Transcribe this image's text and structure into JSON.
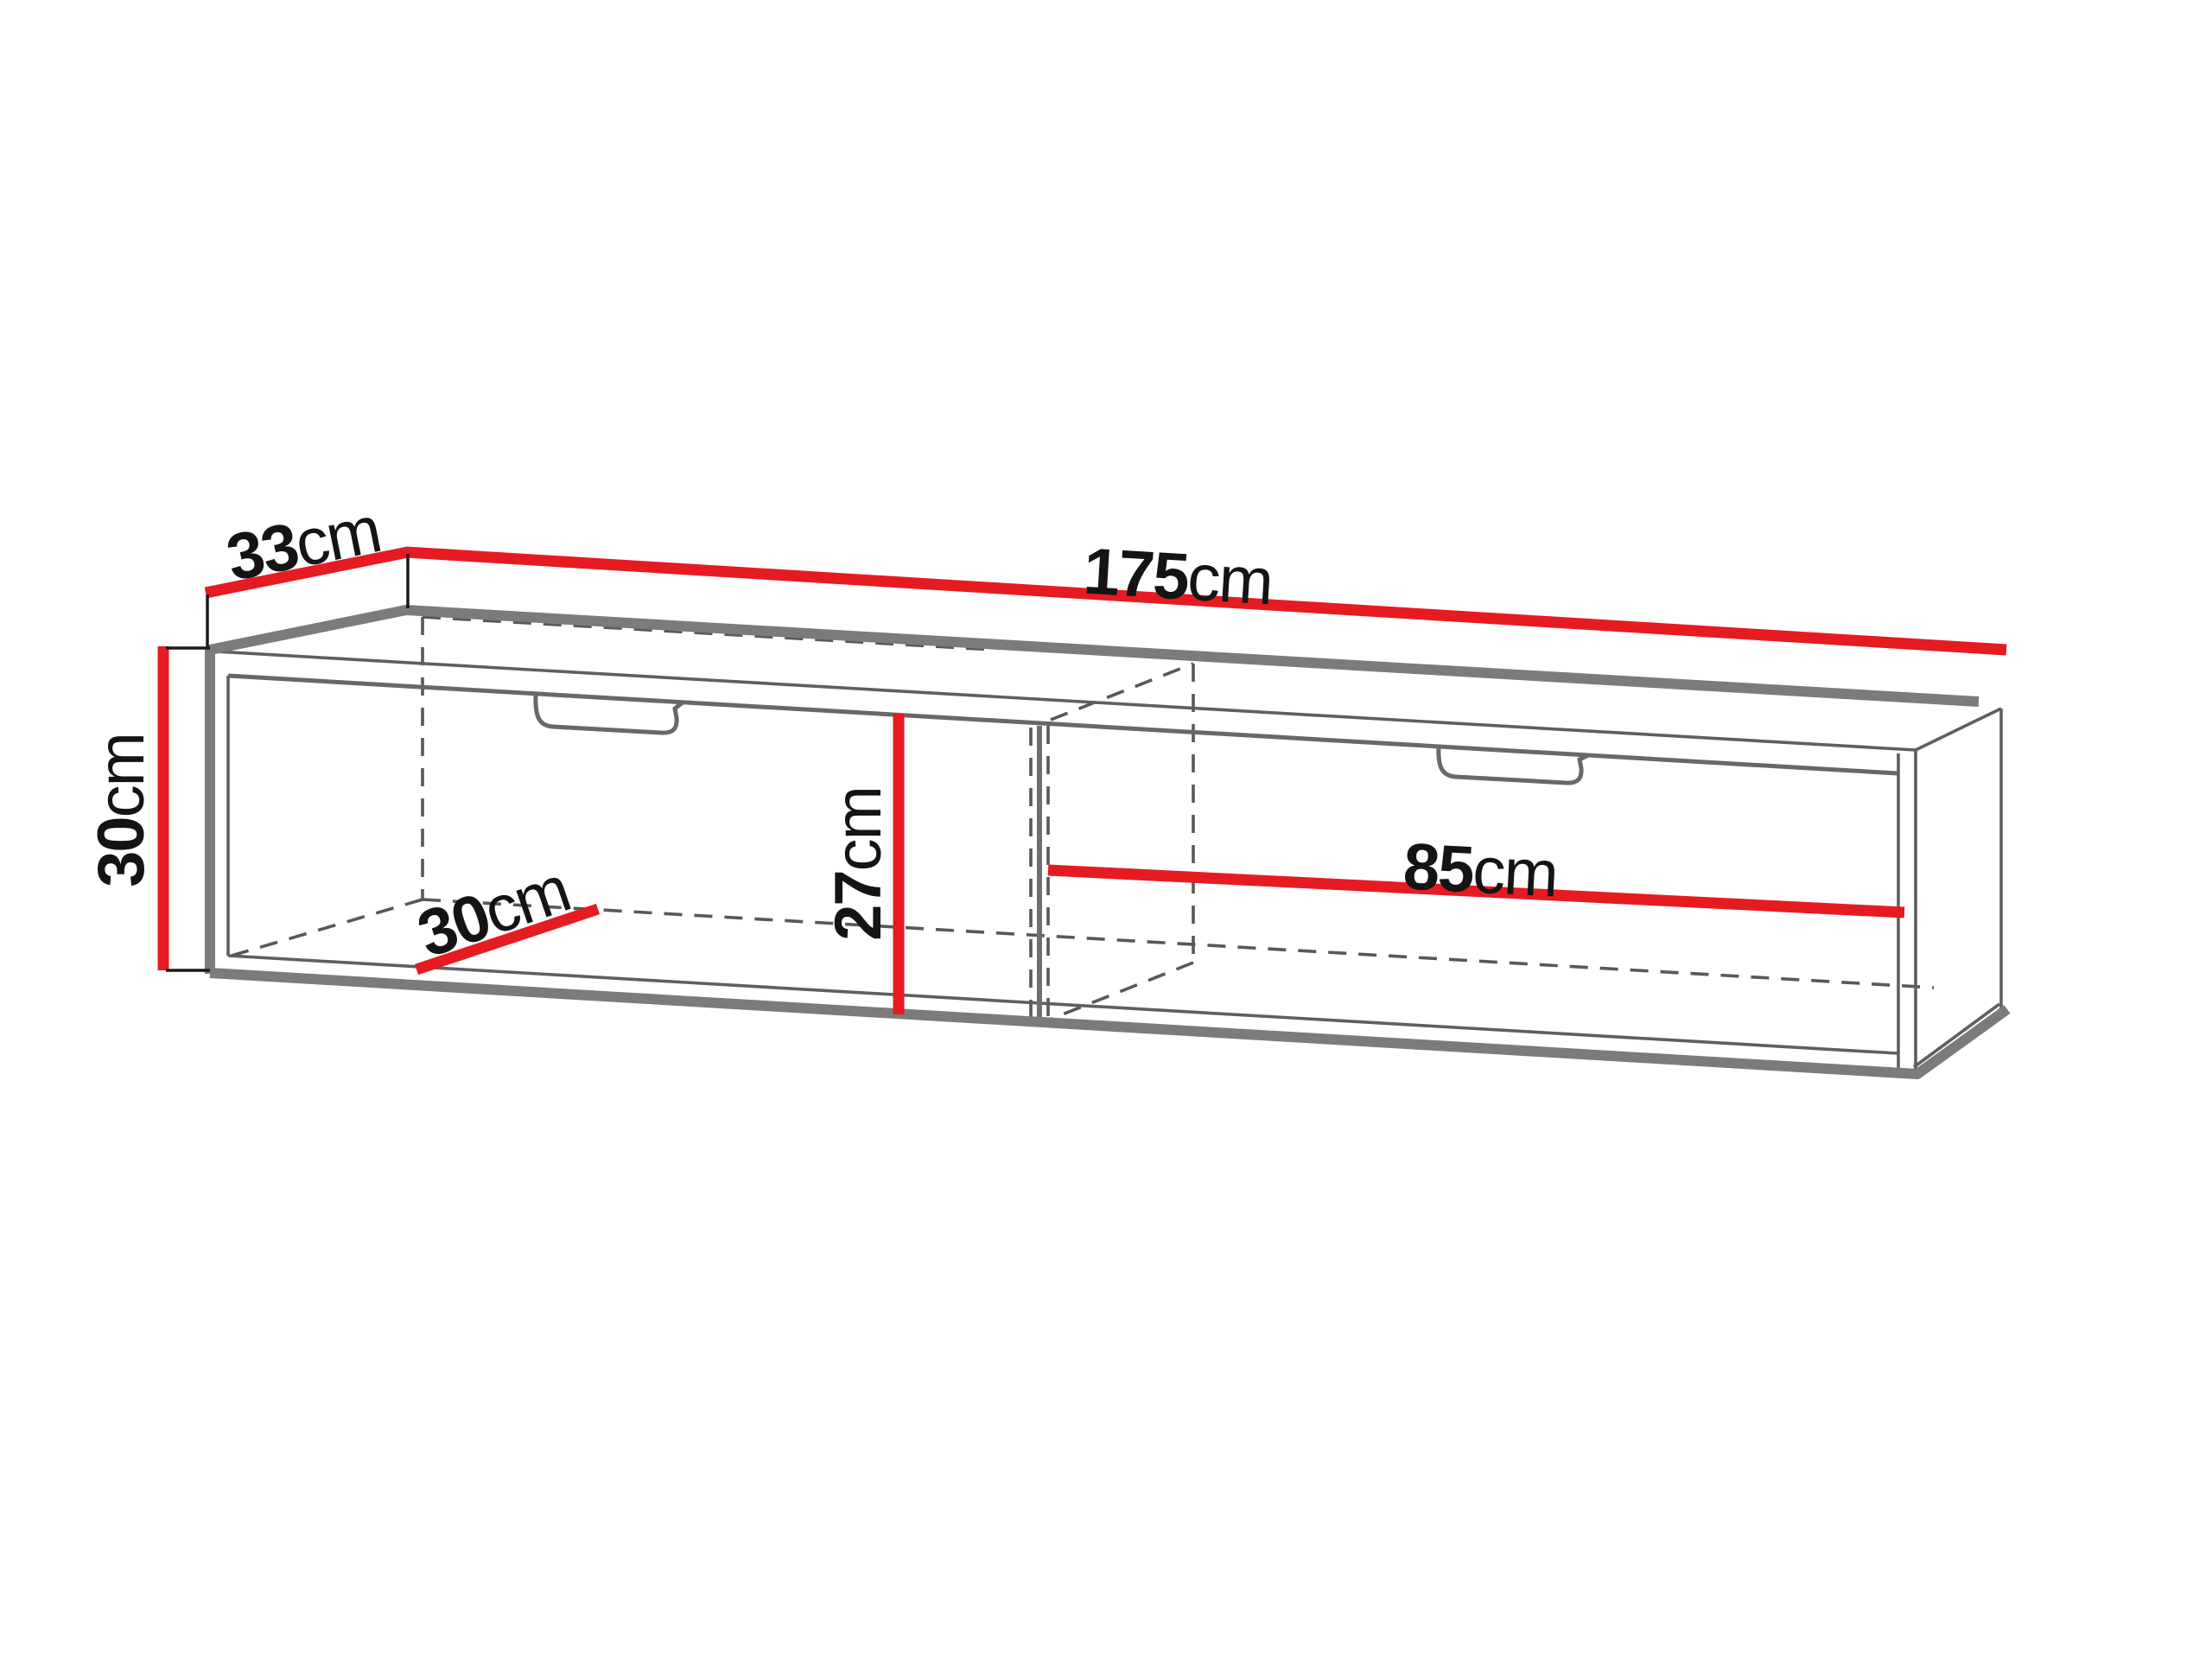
{
  "diagram": {
    "kind": "furniture-dimension-diagram",
    "subject": "wall-mounted TV cabinet with two drawers, perspective line drawing",
    "dims": {
      "depth": {
        "value": "33",
        "unit": "cm"
      },
      "width": {
        "value": "175",
        "unit": "cm"
      },
      "height": {
        "value": "30",
        "unit": "cm"
      },
      "inner_depth": {
        "value": "30",
        "unit": "cm"
      },
      "inner_height": {
        "value": "27",
        "unit": "cm"
      },
      "inner_width_right": {
        "value": "85",
        "unit": "cm"
      }
    },
    "colors": {
      "dimension_red": "#e61b22",
      "outline_thick": "#7b7b7b",
      "outline_thin": "#5f5f5f",
      "hidden_dashed": "#585858",
      "text": "#141414",
      "background": "#ffffff"
    }
  }
}
